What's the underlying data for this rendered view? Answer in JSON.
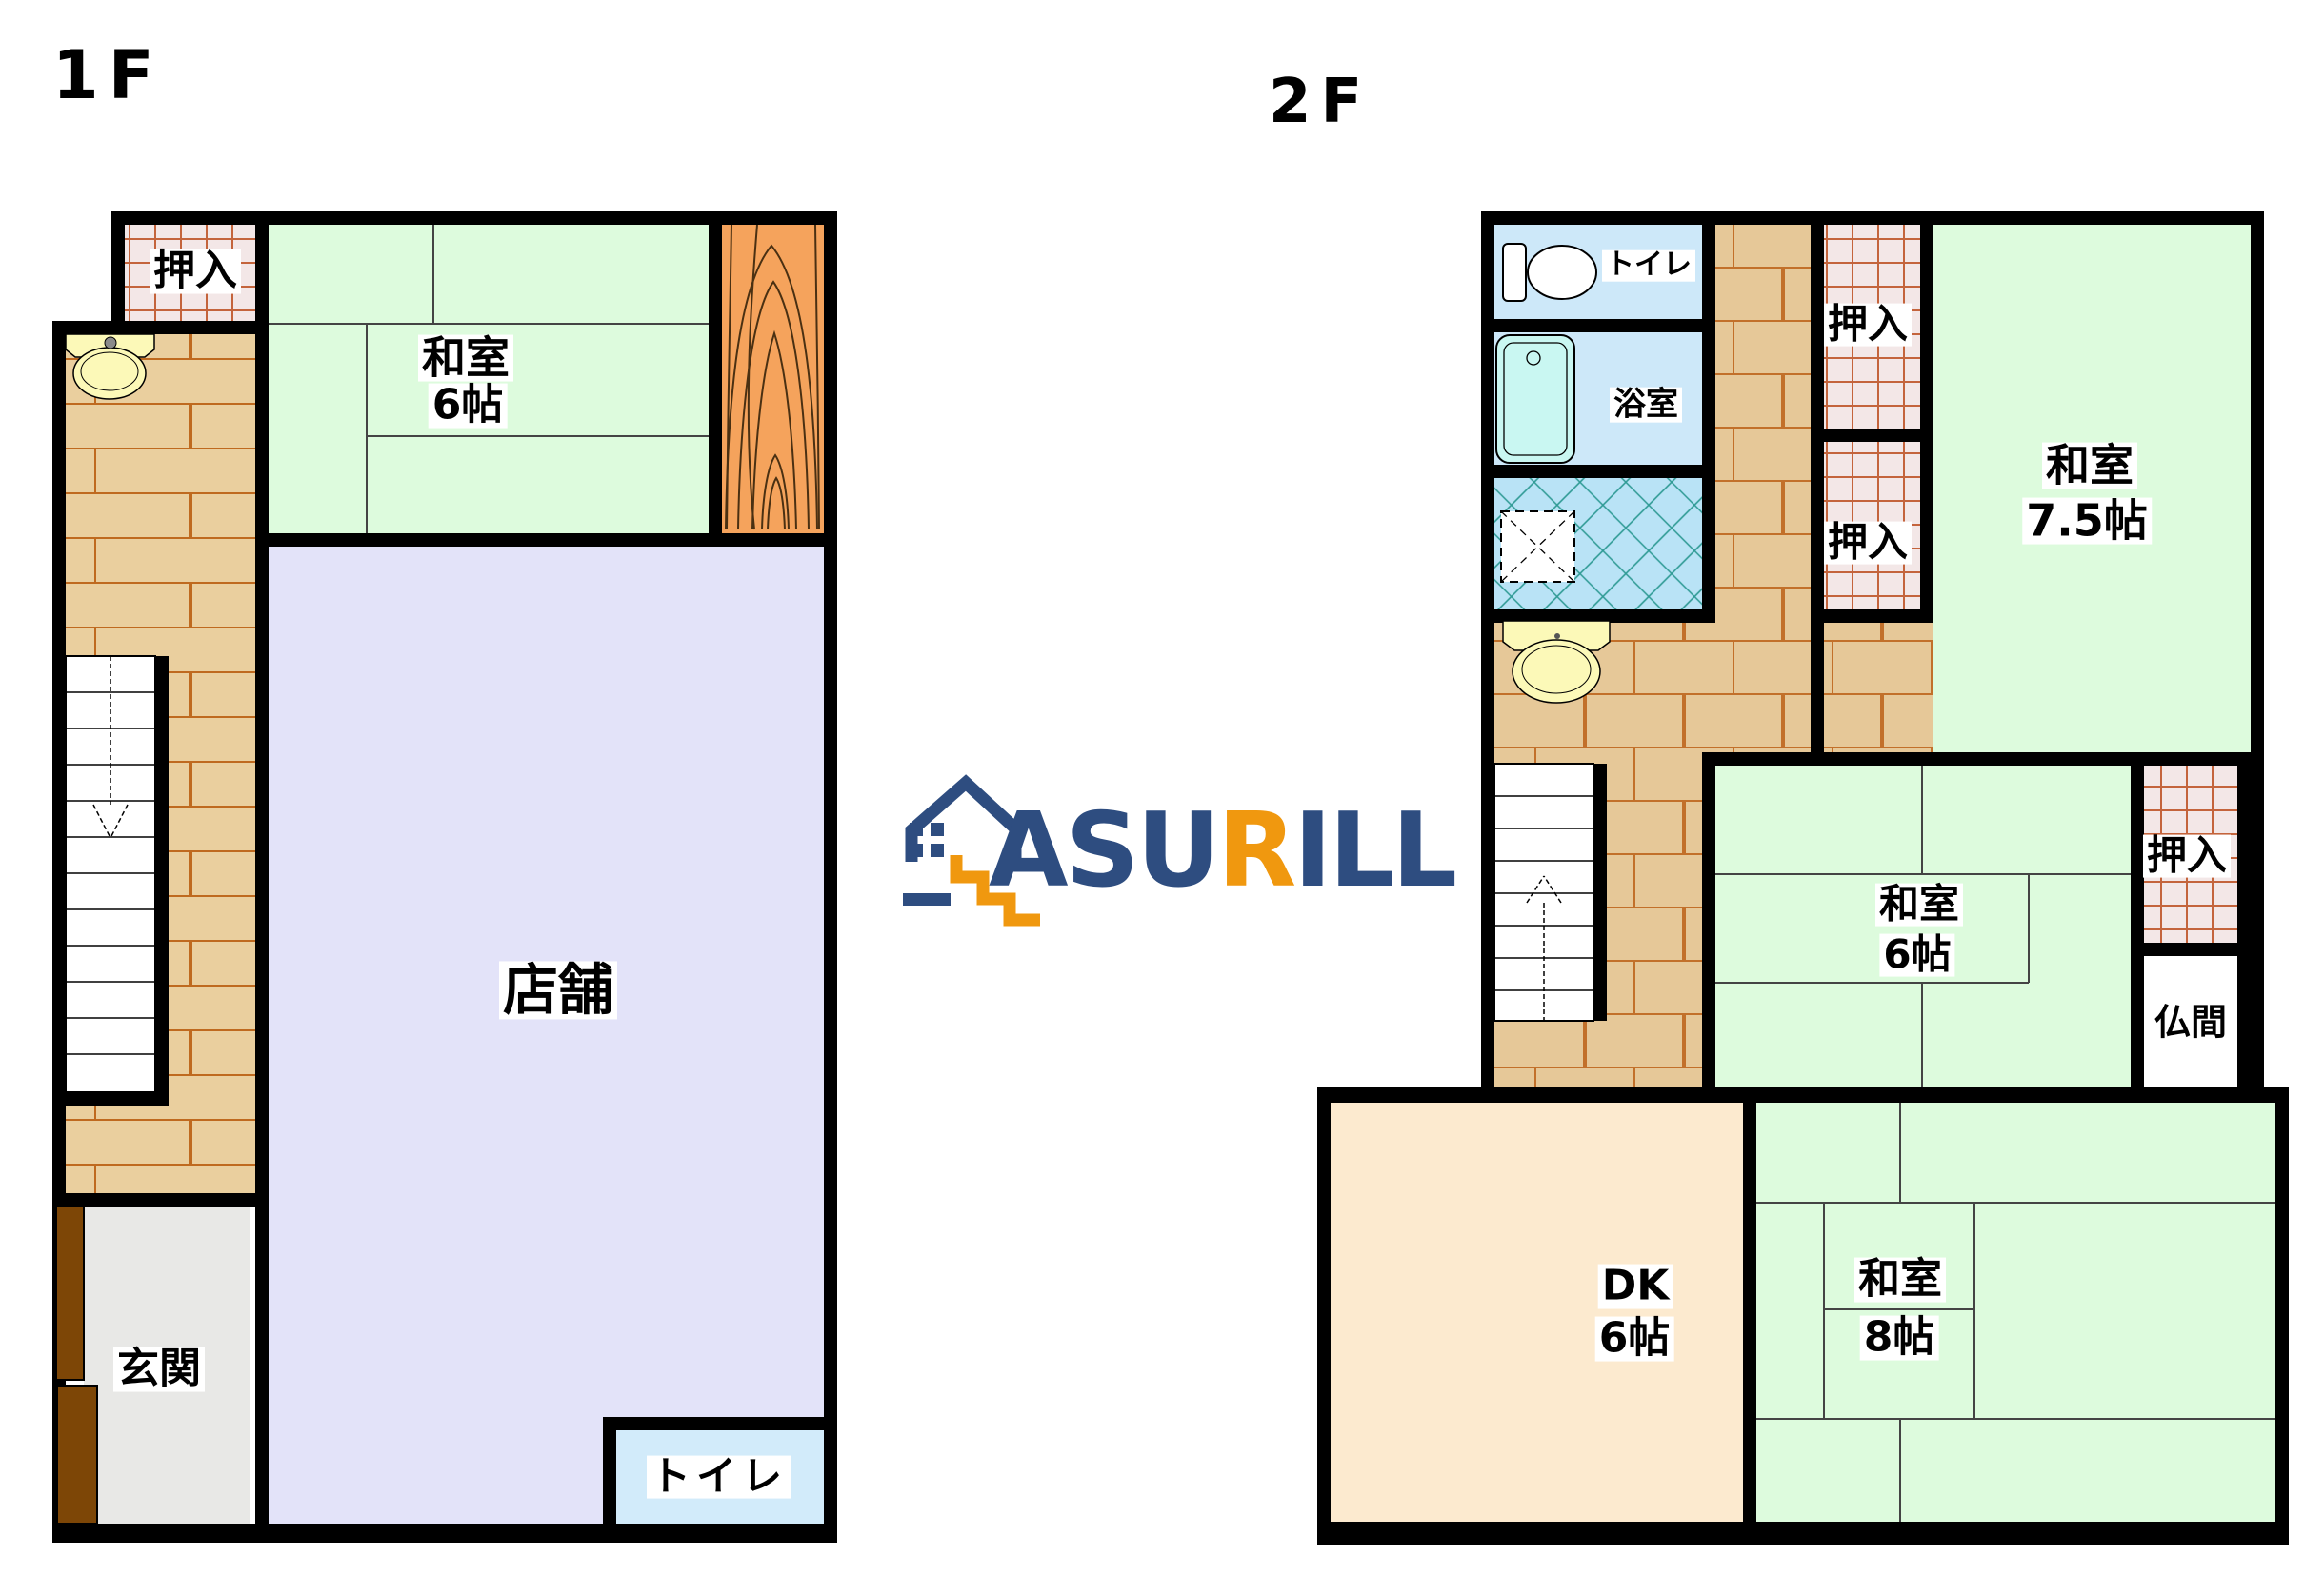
{
  "floor1": {
    "title": "1F",
    "rooms": {
      "oshiire": "押入",
      "washitsu": {
        "name": "和室",
        "size": "6帖"
      },
      "tenpo": "店舗",
      "genkan": "玄関",
      "toilet": "トイレ"
    }
  },
  "floor2": {
    "title": "2F",
    "rooms": {
      "toilet": "トイレ",
      "bath": "浴室",
      "oshiire1": "押入",
      "oshiire2": "押入",
      "washitsu75": {
        "name": "和室",
        "size": "7.5帖"
      },
      "oshiire3": "押入",
      "washitsu6": {
        "name": "和室",
        "size": "6帖"
      },
      "butsuma": "仏間",
      "dk": {
        "name": "DK",
        "size": "6帖"
      },
      "washitsu8": {
        "name": "和室",
        "size": "8帖"
      }
    }
  },
  "logo": {
    "parts": [
      {
        "text": "ASU",
        "color": "#2e4d80"
      },
      {
        "text": "R",
        "color": "#f0980f"
      },
      {
        "text": "ILL",
        "color": "#2e4d80"
      }
    ]
  },
  "palette": {
    "wall": "#000000",
    "tatami_green": "#ddfbdd",
    "wood_floor": "#eacf9e",
    "wood_floor_line": "#bf6a1f",
    "closet_bg": "#f3e7e7",
    "closet_line": "#c4643c",
    "shop_lavender": "#e3e3f9",
    "toilet_blue": "#cde8f9",
    "washroom_blue": "#b9e3f6",
    "washroom_line": "#2e9a94",
    "bathtub_cyan": "#c9f7f2",
    "sink_yellow": "#fcf9b8",
    "genkan_gray": "#e8e8e6",
    "door_brown": "#7d4606",
    "dk_peach": "#fceacf",
    "wood_grain_orange": "#f5a35c",
    "logo_blue": "#2e4d80",
    "logo_orange": "#f0980f"
  }
}
